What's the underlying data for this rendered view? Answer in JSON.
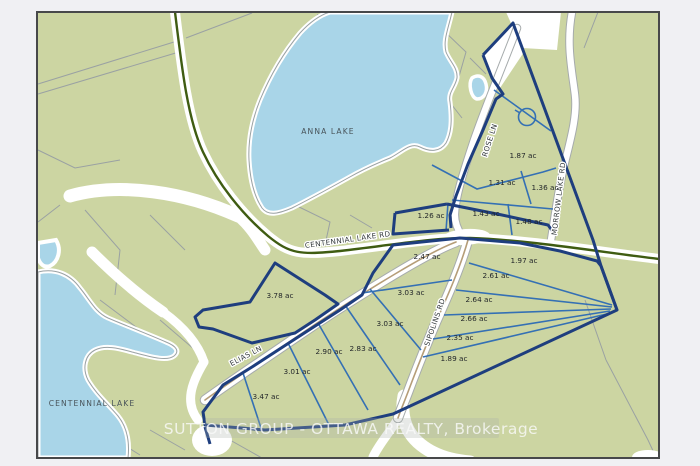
{
  "map": {
    "type": "real-estate plat map",
    "land_color": "#ccd5a2",
    "water_color": "#a9d5e8",
    "border_color": "#47484a",
    "page_background": "#f0f0f3",
    "boundary_navy": "#1e3e7e",
    "lot_line_blue": "#3470b4",
    "road_centerline_green": "#3f5c12",
    "road_centerline_tan": "#b59d78",
    "parcel_line_gray": "#9aa1a3"
  },
  "watermark": {
    "text": "SUTTON GROUP - OTTAWA REALTY, Brokerage"
  },
  "lakes": [
    {
      "name": "ANNA LAKE",
      "x": 328,
      "y": 134
    },
    {
      "name": "CENTENNIAL LAKE",
      "x": 92,
      "y": 406
    }
  ],
  "roads": [
    {
      "name": "CENTENNIAL LAKE RD",
      "x": 348,
      "y": 242,
      "rot": -8
    },
    {
      "name": "ROSE LN",
      "x": 492,
      "y": 141,
      "rot": -72
    },
    {
      "name": "MORROW LAKE RD",
      "x": 561,
      "y": 199,
      "rot": -83
    },
    {
      "name": "ELIAS LN",
      "x": 247,
      "y": 358,
      "rot": -28
    },
    {
      "name": "SIPOLINS RD",
      "x": 437,
      "y": 323,
      "rot": -71
    }
  ],
  "lots": [
    {
      "label": "1.87 ac",
      "x": 523,
      "y": 158
    },
    {
      "label": "1.31 ac",
      "x": 502,
      "y": 185
    },
    {
      "label": "1.36 ac",
      "x": 545,
      "y": 190
    },
    {
      "label": "1.26 ac",
      "x": 431,
      "y": 218
    },
    {
      "label": "1.43 ac",
      "x": 486,
      "y": 216
    },
    {
      "label": "1.48 ac",
      "x": 529,
      "y": 224
    },
    {
      "label": "2.47 ac",
      "x": 427,
      "y": 259
    },
    {
      "label": "1.97 ac",
      "x": 524,
      "y": 263
    },
    {
      "label": "2.61 ac",
      "x": 496,
      "y": 278
    },
    {
      "label": "3.03 ac",
      "x": 411,
      "y": 295
    },
    {
      "label": "2.64 ac",
      "x": 479,
      "y": 302
    },
    {
      "label": "3.78 ac",
      "x": 280,
      "y": 298
    },
    {
      "label": "2.66 ac",
      "x": 474,
      "y": 321
    },
    {
      "label": "3.03 ac",
      "x": 390,
      "y": 326
    },
    {
      "label": "2.35 ac",
      "x": 460,
      "y": 340
    },
    {
      "label": "2.83 ac",
      "x": 363,
      "y": 351
    },
    {
      "label": "2.90 ac",
      "x": 329,
      "y": 354
    },
    {
      "label": "1.89 ac",
      "x": 454,
      "y": 361
    },
    {
      "label": "3.01 ac",
      "x": 297,
      "y": 374
    },
    {
      "label": "3.47 ac",
      "x": 266,
      "y": 399
    }
  ]
}
